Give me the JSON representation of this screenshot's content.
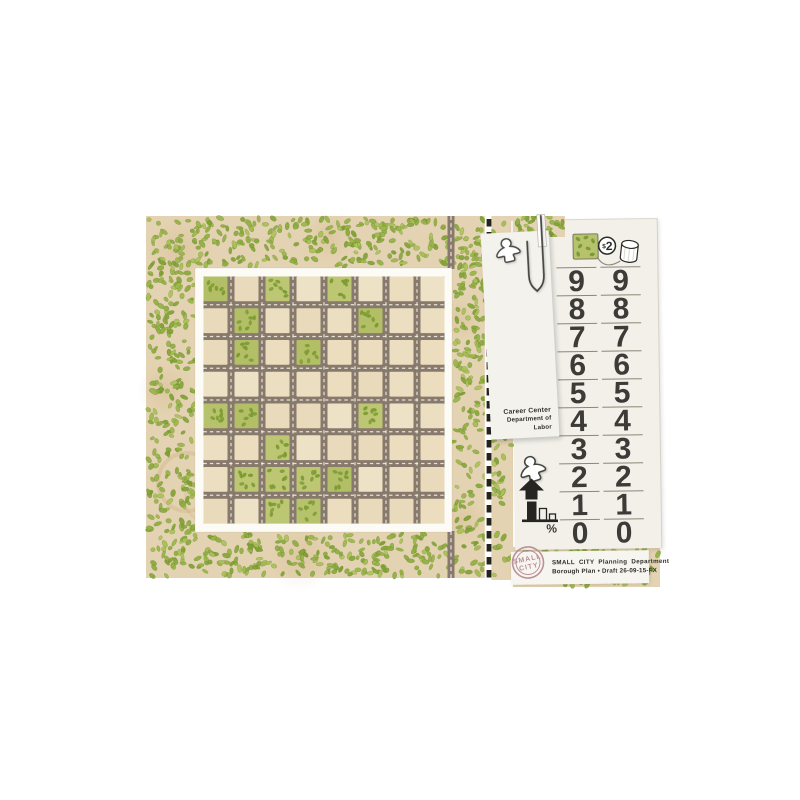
{
  "board": {
    "rows": 8,
    "cols": 8,
    "green_cells": [
      [
        0,
        0
      ],
      [
        0,
        2
      ],
      [
        0,
        4
      ],
      [
        1,
        1
      ],
      [
        1,
        5
      ],
      [
        2,
        1
      ],
      [
        2,
        3
      ],
      [
        4,
        0
      ],
      [
        4,
        1
      ],
      [
        4,
        5
      ],
      [
        5,
        2
      ],
      [
        6,
        1
      ],
      [
        6,
        2
      ],
      [
        6,
        3
      ],
      [
        6,
        4
      ],
      [
        7,
        2
      ],
      [
        7,
        3
      ]
    ],
    "icons": [
      "greenbelt-leaves",
      "street-grid",
      "road-exit-top",
      "road-exit-bottom",
      "cut-line"
    ]
  },
  "legend": {
    "icons": [
      "meeple-icon",
      "paperclip-icon",
      "park-tile-icon",
      "price-badge",
      "barrel-token-icon"
    ],
    "price_symbol": "$",
    "price_value": "2"
  },
  "score_pad": {
    "left_column": [
      "9",
      "8",
      "7",
      "6",
      "5",
      "4",
      "3",
      "2",
      "1",
      "0"
    ],
    "right_column": [
      "9",
      "8",
      "7",
      "6",
      "5",
      "4",
      "3",
      "2",
      "1",
      "0"
    ],
    "percent_label": "%",
    "icons": [
      "meeple-icon",
      "growth-arrow-icon",
      "bar-chart-icon"
    ]
  },
  "card": {
    "line1": "Career Center",
    "line2": "Department of Labor"
  },
  "title_strip": {
    "line1": "SMALL CITY Planning Department",
    "line2": "Borough Plan • Draft 26-09-15-FX",
    "stamp_line1": "SMALL",
    "stamp_line2": "CITY"
  },
  "colors": {
    "parchment": "#e4d3b2",
    "tile_tan": "#ecdfc1",
    "tile_green": "#b7c26c",
    "leaf_dark": "#7d9b34",
    "road": "#87796b",
    "road_dash": "#f4f0e5",
    "frame_white": "#fcfbf5",
    "pad_paper": "#f2f0e9",
    "ink": "#3c3b37",
    "rule_line": "#8a8678",
    "stamp_rose": "#b2848e",
    "cut_dash": "#22221e",
    "leaf_palette": [
      "#8fae3e",
      "#9cb84a",
      "#7fa134",
      "#a8c157",
      "#88a93c",
      "#93b145"
    ],
    "tan_palette": [
      "#ecdfc1",
      "#e9dabb",
      "#eee2c6",
      "#ebddbe"
    ],
    "green_palette": [
      "#b7c26c",
      "#b3bf66",
      "#bcc673"
    ]
  }
}
